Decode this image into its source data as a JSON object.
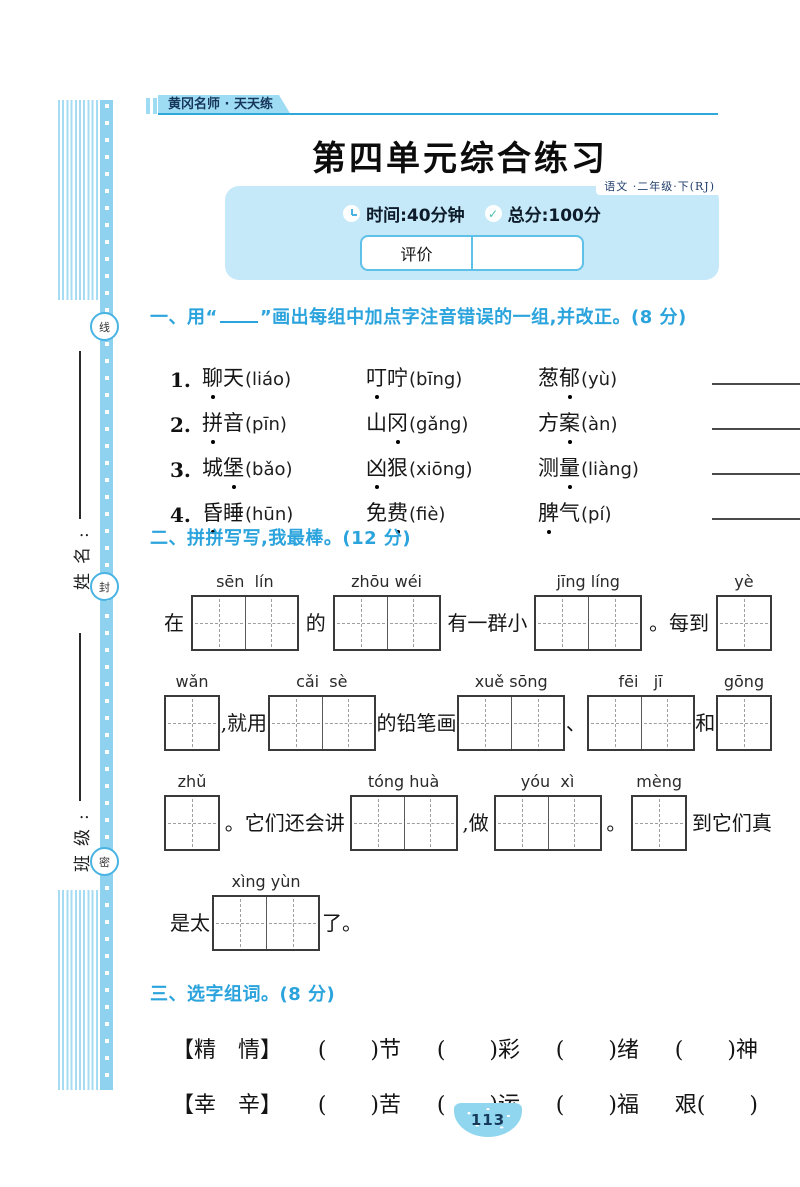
{
  "margin": {
    "seal_chars": [
      "线",
      "封",
      "密"
    ],
    "name_label": "姓名:",
    "class_label": "班级:"
  },
  "header": {
    "brand_tab": "黄冈名师 · 天天练",
    "title": "第四单元综合练习",
    "edition": "语文 ·二年级·下(RJ)",
    "time_label": "时间:40分钟",
    "score_label": "总分:100分",
    "check_glyph": "✓",
    "evaluation_label": "评价",
    "evaluation_value": ""
  },
  "section_one": {
    "heading_pre": "一、用“",
    "heading_post": "”画出每组中加点字注音错误的一组,并改正。(8 分)",
    "items": [
      {
        "num": "1.",
        "terms": [
          {
            "word": "聊天",
            "dot": 0,
            "py": "liáo"
          },
          {
            "word": "叮咛",
            "dot": 0,
            "py": "bīng"
          },
          {
            "word": "葱郁",
            "dot": 1,
            "py": "yù"
          }
        ]
      },
      {
        "num": "2.",
        "terms": [
          {
            "word": "拼音",
            "dot": 0,
            "py": "pīn"
          },
          {
            "word": "山冈",
            "dot": 1,
            "py": "gǎng"
          },
          {
            "word": "方案",
            "dot": 1,
            "py": "àn"
          }
        ]
      },
      {
        "num": "3.",
        "terms": [
          {
            "word": "城堡",
            "dot": 1,
            "py": "bǎo"
          },
          {
            "word": "凶狠",
            "dot": 0,
            "py": "xiōng"
          },
          {
            "word": "测量",
            "dot": 1,
            "py": "liàng"
          }
        ]
      },
      {
        "num": "4.",
        "terms": [
          {
            "word": "昏睡",
            "dot": 0,
            "py": "hūn"
          },
          {
            "word": "免费",
            "dot": 1,
            "py": "fiè"
          },
          {
            "word": "脾气",
            "dot": 0,
            "py": "pí"
          }
        ]
      }
    ]
  },
  "section_two": {
    "heading": "二、拼拼写写,我最棒。(12 分)",
    "lines": [
      [
        {
          "t": "在"
        },
        {
          "b": 2,
          "py": "sēn  lín"
        },
        {
          "t": "的"
        },
        {
          "b": 2,
          "py": "zhōu wéi"
        },
        {
          "t": "有一群小"
        },
        {
          "b": 2,
          "py": "jīng líng"
        },
        {
          "t": "。每到"
        },
        {
          "b": 1,
          "py": "yè"
        }
      ],
      [
        {
          "b": 1,
          "py": "wǎn"
        },
        {
          "t": ",就用"
        },
        {
          "b": 2,
          "py": "cǎi  sè"
        },
        {
          "t": "的铅笔画"
        },
        {
          "b": 2,
          "py": "xuě sōng"
        },
        {
          "t": "、"
        },
        {
          "b": 2,
          "py": "fēi   jī"
        },
        {
          "t": "和"
        },
        {
          "b": 1,
          "py": "gōng"
        }
      ],
      [
        {
          "b": 1,
          "py": "zhǔ"
        },
        {
          "t": "。它们还会讲"
        },
        {
          "b": 2,
          "py": "tóng huà"
        },
        {
          "t": ",做"
        },
        {
          "b": 2,
          "py": "yóu  xì"
        },
        {
          "t": "。"
        },
        {
          "b": 1,
          "py": "mèng"
        },
        {
          "t": "到它们真"
        }
      ],
      [
        {
          "t": "是太"
        },
        {
          "b": 2,
          "py": "xìng yùn"
        },
        {
          "t": "了。"
        }
      ]
    ]
  },
  "section_three": {
    "heading": "三、选字组词。(8 分)",
    "rows": [
      [
        "【精　情】",
        "(　　)节",
        "(　　)彩",
        "(　　)绪",
        "(　　)神"
      ],
      [
        "【幸　辛】",
        "(　　)苦",
        "(　　)运",
        "(　　)福",
        "艰(　　)"
      ]
    ]
  },
  "footer": {
    "page_number": "113"
  }
}
